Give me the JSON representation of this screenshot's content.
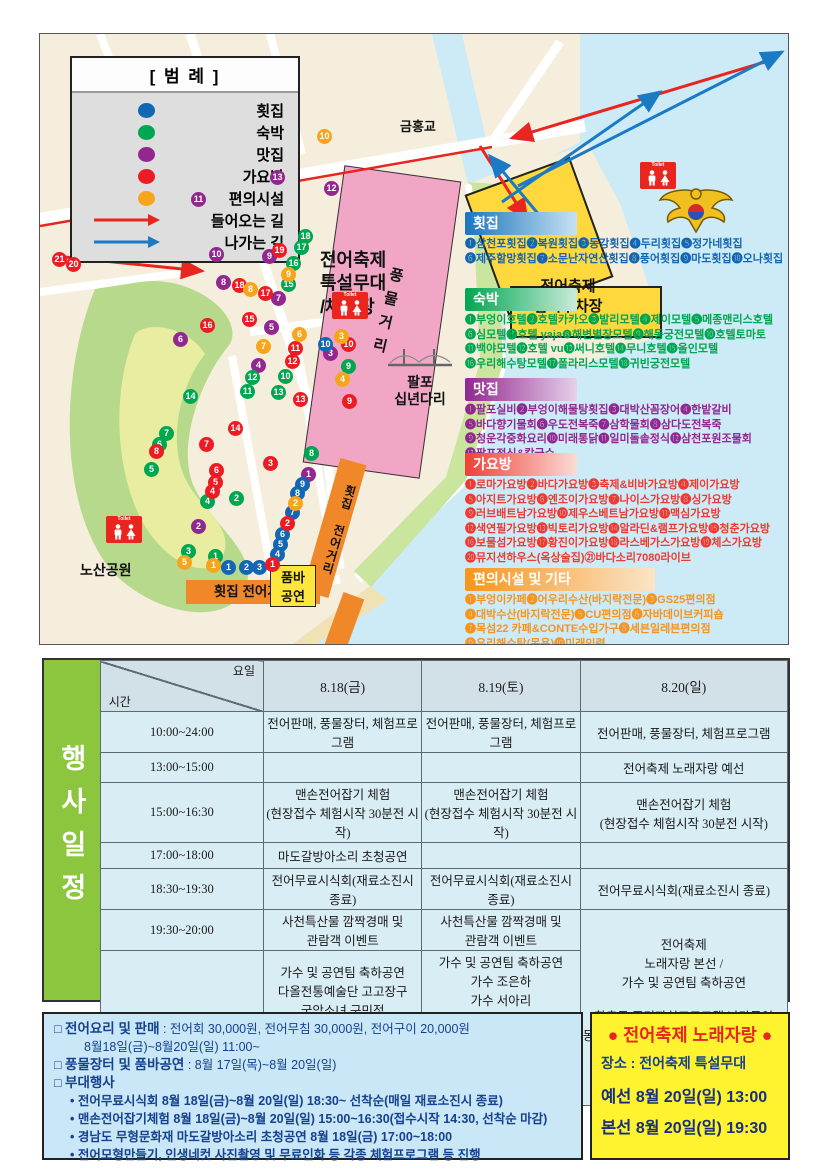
{
  "colors": {
    "hoetjip_blue": "#1266b3",
    "sukbak_green": "#00a650",
    "matjip_purple": "#92278f",
    "gayobang_red": "#ed1c24",
    "pyeonui_orange": "#f7a51d",
    "sea": "#cdeaf7",
    "land": "#f5eedd",
    "park": "#b7d98b",
    "stage_pink": "#f2a6c6",
    "parking_yellow": "#ffd83d",
    "street_orange": "#f0882a",
    "table_cell": "#d9edf5",
    "sidebar_green": "#8cc63e",
    "info_blue": "#c9e7f6",
    "song_yellow": "#fff22e"
  },
  "legend": {
    "title": "[ 범 례 ]",
    "entries": [
      {
        "label": "횟집",
        "color": "#1266b3"
      },
      {
        "label": "숙박",
        "color": "#00a650"
      },
      {
        "label": "맛집",
        "color": "#92278f"
      },
      {
        "label": "가요방",
        "color": "#ed1c24"
      },
      {
        "label": "편의시설",
        "color": "#f7a51d"
      }
    ],
    "incoming": "들어오는 길",
    "outgoing": "나가는 길"
  },
  "map": {
    "labels": {
      "bridge_name": "금홍교",
      "stage": "전어축제\n특설무대\n/체험장",
      "parking": "전어축제\n임시주차장",
      "street_vertical": "풍물거리",
      "bridge2_name": "팔포\n십년다리",
      "park_name": "노산공원",
      "fish_street_v": "횟집 전어거리",
      "fish_street_h": "횟집 전어거리",
      "pumba": "품바\n공연",
      "toilet": "Toilet"
    },
    "dot_colors": {
      "b": "#1266b3",
      "g": "#00a650",
      "p": "#92278f",
      "r": "#ed1c24",
      "o": "#f7a51d"
    },
    "dots": [
      [
        237,
        143,
        "p",
        13
      ],
      [
        158,
        165,
        "p",
        11
      ],
      [
        291,
        154,
        "p",
        12
      ],
      [
        176,
        220,
        "p",
        10
      ],
      [
        229,
        222,
        "p",
        9
      ],
      [
        183,
        248,
        "p",
        8
      ],
      [
        238,
        264,
        "p",
        7
      ],
      [
        140,
        305,
        "p",
        6
      ],
      [
        231,
        293,
        "p",
        5
      ],
      [
        218,
        331,
        "p",
        4
      ],
      [
        290,
        319,
        "p",
        3
      ],
      [
        158,
        492,
        "p",
        2
      ],
      [
        268,
        440,
        "p",
        1
      ],
      [
        285,
        310,
        "b",
        10
      ],
      [
        262,
        450,
        "b",
        9
      ],
      [
        257,
        459,
        "b",
        8
      ],
      [
        252,
        478,
        "b",
        7
      ],
      [
        242,
        500,
        "b",
        6
      ],
      [
        240,
        510,
        "b",
        5
      ],
      [
        237,
        520,
        "b",
        4
      ],
      [
        219,
        533,
        "b",
        3
      ],
      [
        206,
        533,
        "b",
        2
      ],
      [
        188,
        533,
        "b",
        1
      ],
      [
        265,
        202,
        "g",
        18
      ],
      [
        261,
        213,
        "g",
        17
      ],
      [
        253,
        229,
        "g",
        16
      ],
      [
        248,
        250,
        "g",
        15
      ],
      [
        150,
        362,
        "g",
        14
      ],
      [
        238,
        358,
        "g",
        13
      ],
      [
        212,
        343,
        "g",
        12
      ],
      [
        207,
        357,
        "g",
        11
      ],
      [
        245,
        342,
        "g",
        10
      ],
      [
        308,
        332,
        "g",
        9
      ],
      [
        271,
        419,
        "g",
        8
      ],
      [
        126,
        399,
        "g",
        7
      ],
      [
        119,
        410,
        "g",
        6
      ],
      [
        111,
        435,
        "g",
        5
      ],
      [
        167,
        467,
        "g",
        4
      ],
      [
        148,
        517,
        "g",
        3
      ],
      [
        196,
        464,
        "g",
        2
      ],
      [
        175,
        522,
        "g",
        1
      ],
      [
        19,
        225,
        "r",
        21
      ],
      [
        33,
        230,
        "r",
        20
      ],
      [
        239,
        216,
        "r",
        19
      ],
      [
        199,
        251,
        "r",
        18
      ],
      [
        225,
        259,
        "r",
        17
      ],
      [
        167,
        291,
        "r",
        16
      ],
      [
        209,
        285,
        "r",
        15
      ],
      [
        195,
        394,
        "r",
        14
      ],
      [
        260,
        365,
        "r",
        13
      ],
      [
        252,
        327,
        "r",
        12
      ],
      [
        255,
        314,
        "r",
        11
      ],
      [
        308,
        310,
        "r",
        10
      ],
      [
        309,
        367,
        "r",
        9
      ],
      [
        116,
        417,
        "r",
        8
      ],
      [
        166,
        410,
        "r",
        7
      ],
      [
        176,
        436,
        "r",
        6
      ],
      [
        175,
        448,
        "r",
        5
      ],
      [
        172,
        457,
        "r",
        4
      ],
      [
        230,
        429,
        "r",
        3
      ],
      [
        247,
        489,
        "r",
        2
      ],
      [
        232,
        530,
        "r",
        1
      ],
      [
        284,
        102,
        "o",
        10
      ],
      [
        248,
        240,
        "o",
        9
      ],
      [
        210,
        255,
        "o",
        8
      ],
      [
        223,
        312,
        "o",
        7
      ],
      [
        259,
        300,
        "o",
        6
      ],
      [
        144,
        528,
        "o",
        5
      ],
      [
        302,
        345,
        "o",
        4
      ],
      [
        301,
        302,
        "o",
        3
      ],
      [
        255,
        469,
        "o",
        2
      ],
      [
        173,
        531,
        "o",
        1
      ]
    ]
  },
  "directory": {
    "sections": [
      {
        "title": "횟집",
        "color": "#1266b3",
        "top": 178,
        "items": [
          "삼천포횟집",
          "복원횟집",
          "동강횟집",
          "두리횟집",
          "정가네횟집",
          "제주할망횟집",
          "소문난자연산횟집",
          "풍어횟집",
          "마도횟집",
          "오나횟집"
        ]
      },
      {
        "title": "숙박",
        "color": "#00a650",
        "top": 254,
        "items": [
          "부엉이호텔",
          "호텔카카오",
          "발리모텔",
          "제이모텔",
          "메종맨리스호텔",
          "심모텔",
          "호텔 yaja",
          "해변별장모텔",
          "해동궁전모텔",
          "호텔토마토",
          "백야모텔",
          "호텔 vu",
          "써니호텔",
          "무니호텔",
          "올인모텔",
          "우리해수탕모텔",
          "폴라리스모텔",
          "귀빈궁전모텔"
        ]
      },
      {
        "title": "맛집",
        "color": "#92278f",
        "top": 344,
        "items": [
          "팔포실비",
          "부엉이해물탕횟집",
          "대박산꼼장어",
          "한밭갈비",
          "바다향기물회",
          "우도전복죽",
          "삼학물회",
          "삼다도전복죽",
          "청운각중화요리",
          "미래통닭",
          "일미돌솥정식",
          "삼천포원조물회",
          "팔포정식&칼국수"
        ]
      },
      {
        "title": "가요방",
        "color": "#ed1c24",
        "top": 419,
        "items": [
          "로마가요방",
          "바다가요방",
          "축제&비바가요방",
          "제이가요방",
          "아지트가요방",
          "엔조이가요방",
          "나이스가요방",
          "싱가요방",
          "러브배트남가요방",
          "제우스베트남가요방",
          "맥심가요방",
          "색연필가요방",
          "빅토리가요방",
          "알라딘&램프가요방",
          "청춘가요방",
          "보물섬가요방",
          "황진이가요방",
          "라스베가스가요방",
          "체스가요방",
          "뮤지션하우스(옥상술집)",
          "바다소리7080라이브"
        ]
      },
      {
        "title": "편의시설 및 기타",
        "color": "#f7a51d",
        "top": 534,
        "items": [
          "부엉이카페",
          "어우리수산(바지락전문)",
          "GS25편의점",
          "대박수산(바지락전문)",
          "CU편의점",
          "자바데이브커피숍",
          "목섬22 카페&CONTE수입가구",
          "세븐일레븐편의점",
          "우리해수탕(목욕)",
          "미래인력"
        ]
      }
    ]
  },
  "schedule": {
    "sidebar": "행사일정",
    "corner": {
      "time": "시간",
      "day": "요일"
    },
    "columns": [
      "8.18(금)",
      "8.19(토)",
      "8.20(일)"
    ],
    "rows": [
      {
        "time": "10:00~24:00",
        "cells": [
          "전어판매, 풍물장터, 체험프로그램",
          "전어판매, 풍물장터, 체험프로그램",
          "전어판매, 풍물장터, 체험프로그램"
        ]
      },
      {
        "time": "13:00~15:00",
        "cells": [
          "",
          "",
          "전어축제 노래자랑 예선"
        ]
      },
      {
        "time": "15:00~16:30",
        "cells": [
          "맨손전어잡기 체험\n(현장접수 체험시작 30분전 시작)",
          "맨손전어잡기 체험\n(현장접수 체험시작 30분전 시작)",
          "맨손전어잡기 체험\n(현장접수 체험시작 30분전 시작)"
        ]
      },
      {
        "time": "17:00~18:00",
        "cells": [
          "마도갈방아소리 초청공연",
          "",
          ""
        ]
      },
      {
        "time": "18:30~19:30",
        "cells": [
          "전어무료시식회(재료소진시 종료)",
          "전어무료시식회(재료소진시 종료)",
          "전어무료시식회(재료소진시 종료)"
        ]
      },
      {
        "time": "19:30~20:00",
        "cells": [
          "사천특산물 깜짝경매 및\n관람객 이벤트",
          "사천특산물 깜짝경매 및\n관람객 이벤트",
          "전어축제\n노래자랑 본선 /\n가수 및 공연팀 축하공연\n\n향촌동 주민자치프로그램 난타공연\n동서금동 주민자치프로그램 스포츠댄스\n가수 백프로\n댄스팀 레트로"
        ]
      },
      {
        "time": "20:00~22:00",
        "cells": [
          "가수 및 공연팀 축하공연\n다올전통예술단 고고장구\n국악소녀 구민정\n가수 정미라\n가수 박재범\n가수 한별이\n품바여신 버드리",
          "가수 및 공연팀 축하공연\n가수 조은하\n가수 서아리\n가수 배진아\n판소리&민요 이윤옥 외 1인\n가수 문수화\n가수 김혜진\n가수 유진표"
        ]
      }
    ]
  },
  "info": {
    "rows": [
      {
        "bullet": "□",
        "label": "전어요리 및 판매",
        "text": " : 전어회 30,000원, 전어무침 30,000원, 전어구이 20,000원",
        "cont": "8월18일(금)~8월20일(일) 11:00~"
      },
      {
        "bullet": "□",
        "label": "풍물장터 및 품바공연",
        "text": " : 8월 17일(목)~8월 20일(일)"
      },
      {
        "bullet": "□",
        "label": "부대행사",
        "text": ""
      }
    ],
    "sub_bullets": [
      "• 전어무료시식회 8월 18일(금)~8월 20일(일) 18:30~ 선착순(매일 재료소진시 종료)",
      "• 맨손전어잡기체험 8월 18일(금)~8월 20일(일) 15:00~16:30(접수시작 14:30, 선착순 마감)",
      "• 경남도 무형문화재  마도갈방아소리 초청공연 8월 18일(금) 17:00~18:00",
      "• 전어모형만들기, 인생네컷 사진촬영 및 무료인화 등 각종 체험프로그램 등 진행"
    ]
  },
  "karaoke": {
    "title": "● 전어축제 노래자랑 ●",
    "place": "장소 : 전어축제 특설무대",
    "rows": [
      {
        "label": "예선",
        "text": "8월 20일(일) 13:00"
      },
      {
        "label": "본선",
        "text": "8월 20일(일) 19:30"
      }
    ]
  }
}
